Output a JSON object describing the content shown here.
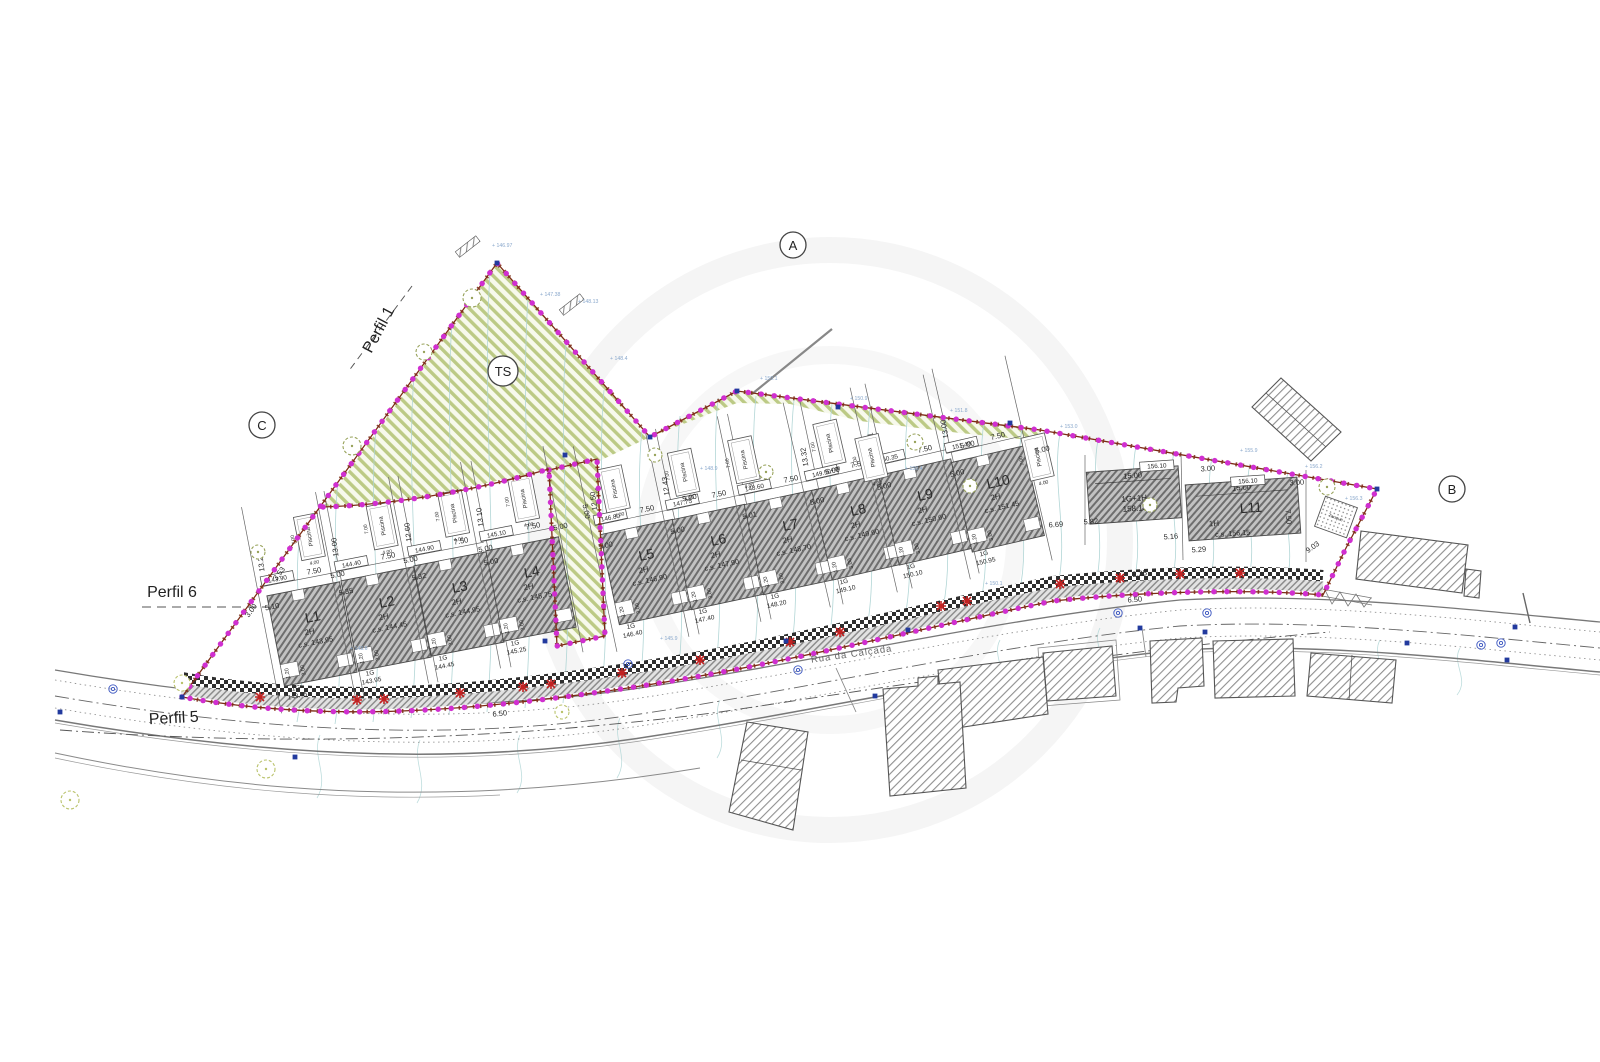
{
  "drawing_type": "site-plan",
  "colors": {
    "boundary_magenta": "#d02fd0",
    "boundary_red": "#7d2b15",
    "green_hatch": "#bcca85",
    "house_hatch": "#6e6e6e",
    "contour": "#aed4d4",
    "spot_elev": "#8aa8cc",
    "red_marker": "#c22222",
    "survey_blue": "#223a9e"
  },
  "markers": [
    {
      "label": "A",
      "x": 793,
      "y": 245
    },
    {
      "label": "B",
      "x": 1452,
      "y": 489
    },
    {
      "label": "C",
      "x": 262,
      "y": 425
    },
    {
      "label": "TS",
      "x": 503,
      "y": 371
    }
  ],
  "profiles": [
    {
      "label": "Perfil 1",
      "x": 383,
      "y": 332,
      "rot": -62
    },
    {
      "label": "Perfil 6",
      "x": 172,
      "y": 597,
      "rot": 0
    },
    {
      "label": "Perfil 5",
      "x": 174,
      "y": 723,
      "rot": -3
    }
  ],
  "road": {
    "name": "Rua da Calçada"
  },
  "tanque": {
    "label": "Tanque",
    "x": 1336,
    "y": 517,
    "rot": 20
  },
  "pool": {
    "label": "Piscina",
    "length": "7.00",
    "width": "4.00"
  },
  "bottom_dims": [
    "1.20",
    "3.00"
  ],
  "lots": [
    {
      "name": "L1",
      "x": 312,
      "y": 634,
      "a": -11,
      "floors": "2H",
      "cs": "c.s. 143.95",
      "box": "143.90",
      "garage": "1G",
      "garage_elev": "143.45",
      "width": "7.50",
      "front": "5.10",
      "depth": "13.23",
      "pool_dx": 16,
      "pool_dy": -96
    },
    {
      "name": "L2",
      "x": 386,
      "y": 619,
      "a": -11,
      "floors": "2H",
      "cs": "c.s. 144.45",
      "box": "144.40",
      "garage": "1G",
      "garage_elev": "143.95",
      "width": "7.50",
      "front": "5.35",
      "depth": "13.00",
      "pool_dx": 14,
      "pool_dy": -92
    },
    {
      "name": "L3",
      "x": 459,
      "y": 604,
      "a": -11,
      "floors": "2H",
      "cs": "c.s. 144.95",
      "box": "144.90",
      "garage": "1G",
      "garage_elev": "144.45",
      "width": "7.50",
      "front": "5.32",
      "depth": "12.60",
      "pool_dx": 12,
      "pool_dy": -90
    },
    {
      "name": "L4",
      "x": 531,
      "y": 589,
      "a": -11,
      "floors": "2H",
      "cs": "c.s. 145.75",
      "box": "145.10",
      "garage": "1G",
      "garage_elev": "145.25",
      "width": "7.50",
      "front": "5.00",
      "depth": "13.10",
      "pool_dx": 10,
      "pool_dy": -90
    },
    {
      "name": "L5",
      "x": 646,
      "y": 572,
      "a": -12,
      "floors": "2H",
      "cs": "c.s. 146.90",
      "box": "146.80",
      "garage": "1G",
      "garage_elev": "146.40",
      "width": "7.50",
      "front": "5.00",
      "depth": "12.50",
      "pool_dx": -14,
      "pool_dy": -88
    },
    {
      "name": "L6",
      "x": 718,
      "y": 557,
      "a": -12,
      "floors": "2H",
      "cs": "c.s. 147.90",
      "box": "147.75",
      "garage": "1G",
      "garage_elev": "147.40",
      "width": "7.50",
      "front": "5.00",
      "depth": "12.43",
      "pool_dx": -16,
      "pool_dy": -90
    },
    {
      "name": "L7",
      "x": 790,
      "y": 542,
      "a": -12,
      "floors": "2H",
      "cs": "c.s. 148.70",
      "box": "148.60",
      "garage": "1G",
      "garage_elev": "148.20",
      "width": "7.50",
      "front": "5.01",
      "depth": "13.22",
      "pool_dx": -28,
      "pool_dy": -90
    },
    {
      "name": "L8",
      "x": 858,
      "y": 527,
      "a": -13,
      "floors": "2H",
      "cs": "c.s. 149.60",
      "box": "149.50",
      "garage": "1G",
      "garage_elev": "149.10",
      "width": "7.50",
      "front": "5.00",
      "depth": "13.32",
      "pool_dx": -9,
      "pool_dy": -88
    },
    {
      "name": "L9",
      "x": 925,
      "y": 512,
      "a": -13,
      "floors": "2H",
      "cs": "c.s. 150.60",
      "box": "150.35",
      "garage": "1G",
      "garage_elev": "150.10",
      "width": "7.50",
      "front": "5.00",
      "depth": "10.61",
      "pool_dx": -40,
      "pool_dy": -65
    },
    {
      "name": "L10",
      "x": 998,
      "y": 499,
      "a": -13,
      "floors": "2H",
      "cs": "c.s. 151.45",
      "box": "151.40",
      "garage": "1G",
      "garage_elev": "150.95",
      "width": "7.50",
      "front": "5.00",
      "depth": "13.00",
      "pool_dx": 48,
      "pool_dy": -32
    }
  ],
  "lot11": {
    "name": "L11",
    "x": 1243,
    "y": 509,
    "a": -4,
    "floors": "1H",
    "cs": "c.s. 156.15",
    "dim": "15.00"
  },
  "annex": {
    "label1": "1G+1H",
    "label2": "158.15",
    "x": 1134,
    "y": 495,
    "a": -4,
    "dim": "15.00"
  },
  "extra_boxes": [
    {
      "t": "156.10",
      "x": 1157,
      "y": 468,
      "r": -4
    },
    {
      "t": "156.10",
      "x": 1248,
      "y": 483,
      "r": -4
    }
  ],
  "extra_dims": [
    {
      "t": "5.00",
      "x": 338,
      "y": 577,
      "r": -11
    },
    {
      "t": "5.00",
      "x": 411,
      "y": 562,
      "r": -11
    },
    {
      "t": "5.00",
      "x": 486,
      "y": 551,
      "r": -11
    },
    {
      "t": "5.00",
      "x": 561,
      "y": 529,
      "r": -12
    },
    {
      "t": "5.00",
      "x": 584,
      "y": 512,
      "r": 78
    },
    {
      "t": "5.00",
      "x": 690,
      "y": 500,
      "r": -12
    },
    {
      "t": "5.00",
      "x": 833,
      "y": 473,
      "r": -12
    },
    {
      "t": "5.00",
      "x": 968,
      "y": 447,
      "r": -13
    },
    {
      "t": "5.00",
      "x": 1043,
      "y": 452,
      "r": -13
    },
    {
      "t": "3.53",
      "x": 281,
      "y": 575,
      "r": -53
    },
    {
      "t": "3.00",
      "x": 253,
      "y": 612,
      "r": -53
    },
    {
      "t": "6.50",
      "x": 500,
      "y": 716,
      "r": -6
    },
    {
      "t": "6.50",
      "x": 1135,
      "y": 602,
      "r": -5
    },
    {
      "t": "6.69",
      "x": 1056,
      "y": 527,
      "r": -4
    },
    {
      "t": "5.82",
      "x": 1091,
      "y": 524,
      "r": -4
    },
    {
      "t": "5.16",
      "x": 1171,
      "y": 539,
      "r": -4
    },
    {
      "t": "5.29",
      "x": 1199,
      "y": 552,
      "r": -4
    },
    {
      "t": "9.03",
      "x": 1314,
      "y": 549,
      "r": -35
    },
    {
      "t": "2.25",
      "x": 1140,
      "y": 576,
      "r": -8
    },
    {
      "t": "3.00",
      "x": 1208,
      "y": 471,
      "r": -4
    },
    {
      "t": "3.00",
      "x": 1297,
      "y": 485,
      "r": -4
    },
    {
      "t": "7.50",
      "x": 1286,
      "y": 517,
      "r": 86
    }
  ],
  "spot_elevations": [
    {
      "t": "+ 147.38",
      "x": 540,
      "y": 296
    },
    {
      "t": "+ 148.13",
      "x": 578,
      "y": 303
    },
    {
      "t": "+ 146.97",
      "x": 492,
      "y": 247
    },
    {
      "t": "+ 148.4",
      "x": 610,
      "y": 360
    },
    {
      "t": "+ 150.1",
      "x": 760,
      "y": 380
    },
    {
      "t": "+ 150.9",
      "x": 850,
      "y": 400
    },
    {
      "t": "+ 151.8",
      "x": 950,
      "y": 412
    },
    {
      "t": "+ 153.0",
      "x": 1060,
      "y": 428
    },
    {
      "t": "+ 155.9",
      "x": 1240,
      "y": 452
    },
    {
      "t": "+ 156.2",
      "x": 1305,
      "y": 468
    },
    {
      "t": "+ 148.9",
      "x": 700,
      "y": 470
    },
    {
      "t": "+ 150.4",
      "x": 905,
      "y": 470
    },
    {
      "t": "+ 143.6",
      "x": 350,
      "y": 650
    },
    {
      "t": "+ 145.9",
      "x": 660,
      "y": 640
    },
    {
      "t": "+ 150.1",
      "x": 985,
      "y": 585
    },
    {
      "t": "+ 156.3",
      "x": 1345,
      "y": 500
    }
  ],
  "decorations": {
    "red_cross_markers": [
      [
        260,
        697
      ],
      [
        357,
        700
      ],
      [
        384,
        699
      ],
      [
        460,
        693
      ],
      [
        523,
        687
      ],
      [
        551,
        684
      ],
      [
        622,
        673
      ],
      [
        700,
        660
      ],
      [
        790,
        642
      ],
      [
        840,
        632
      ],
      [
        941,
        606
      ],
      [
        967,
        601
      ],
      [
        1060,
        584
      ],
      [
        1120,
        578
      ],
      [
        1180,
        574
      ],
      [
        1240,
        573
      ]
    ],
    "trees_site": [
      [
        472,
        298,
        9
      ],
      [
        424,
        352,
        8
      ],
      [
        352,
        446,
        9
      ],
      [
        258,
        552,
        7
      ],
      [
        655,
        455,
        7
      ],
      [
        766,
        472,
        7
      ],
      [
        915,
        442,
        8
      ],
      [
        970,
        486,
        7
      ],
      [
        1150,
        505,
        7
      ],
      [
        1327,
        487,
        8
      ]
    ],
    "trees_road": [
      [
        182,
        683,
        8
      ],
      [
        266,
        769,
        9
      ],
      [
        70,
        800,
        9
      ],
      [
        562,
        712,
        7
      ]
    ],
    "survey_squares": [
      [
        497,
        263
      ],
      [
        737,
        391
      ],
      [
        838,
        407
      ],
      [
        1010,
        423
      ],
      [
        1377,
        489
      ],
      [
        182,
        697
      ],
      [
        650,
        437
      ],
      [
        565,
        455
      ],
      [
        60,
        712
      ],
      [
        295,
        757
      ],
      [
        545,
        641
      ],
      [
        786,
        641
      ],
      [
        875,
        696
      ],
      [
        908,
        630
      ],
      [
        1140,
        628
      ],
      [
        1205,
        632
      ],
      [
        1407,
        643
      ],
      [
        1515,
        627
      ],
      [
        1507,
        660
      ]
    ],
    "manholes": [
      [
        113,
        689
      ],
      [
        628,
        664
      ],
      [
        798,
        670
      ],
      [
        1118,
        613
      ],
      [
        1207,
        613
      ],
      [
        1481,
        645
      ],
      [
        1501,
        643
      ]
    ]
  }
}
